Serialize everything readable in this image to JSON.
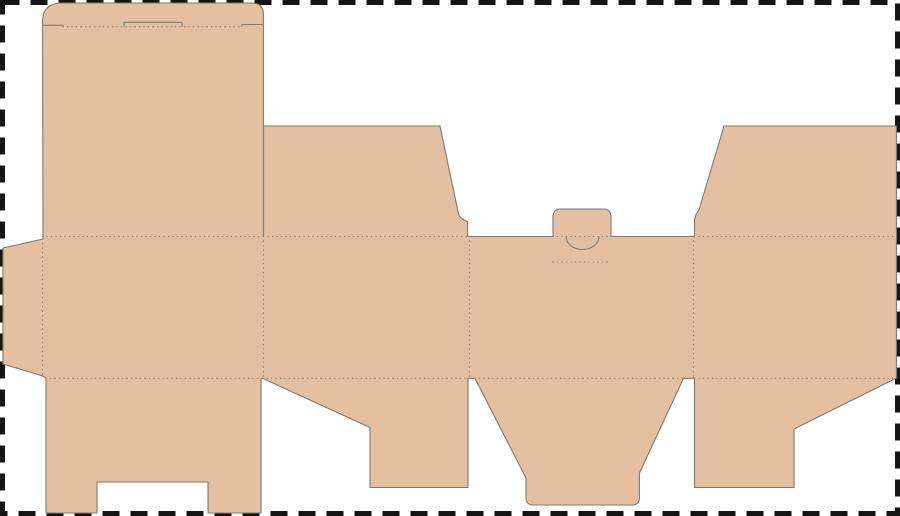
{
  "meta": {
    "description": "Flat packaging dieline (unfolded tuck-end box die-cut template) on a white artboard with a dashed trim border",
    "canvas": {
      "width": 900,
      "height": 516
    }
  },
  "colors": {
    "background": "#ffffff",
    "cardboard_fill": "#e5c0a0",
    "cut_line": "#7f7a72",
    "fold_line": "#8a7f70",
    "artboard_border": "#151515"
  },
  "artboard_border": {
    "inset": 2.5,
    "stroke_width": 5,
    "dash": "17 11"
  },
  "dieline": {
    "blank_path": "M 42.5,25.3 L 42.5,22 Q 42.5,3 62,3 L 251.5,3 Q 263.5,3 263.5,15 L 263.5,126 L 440,126 L 458.5,214 Q 460.5,219.5 467.5,221.5 L 467.5,236.5 L 553,236.5 L 553,217 Q 553,209 561,209 L 603,209 Q 611,209 611,217 L 611,236.5 L 694.5,236.5 L 694.5,221.5 Q 694.8,214.5 698.8,210.5 L 724,126 L 896.5,126 L 896.5,378 L 794,429 L 794,487.5 L 694.5,487.5 L 694.5,378.3 L 683.5,378.3 L 639.5,473 L 639.5,497.5 Q 639.5,505 632,505 L 533.5,505 Q 526,505 526,497.5 L 526,478 L 475,378.3 L 468,378.3 L 468,487.5 L 370,487.5 L 370,427.5 L 262.5,378.3 L 261,378.3 L 261,513 L 208,513 L 208,482 L 97,482 L 97,513 L 46,513 L 46,378.3 L 43,376 L 3,364 L 3,248 L 43,239 Z",
    "cut_lines": [
      {
        "name": "front-side-panel-divider-cut",
        "d": "M 263.5,126 L 263.5,236.5"
      },
      {
        "name": "lid-shoulder-cut-left",
        "d": "M 42.5,25.3 L 63,25.3 L 63,26.8"
      },
      {
        "name": "lid-shoulder-cut-right",
        "d": "M 242,26.8 L 242,24.5 L 263.5,24.5"
      },
      {
        "name": "lid-thumb-tab-cut",
        "d": "M 124,26.8 L 124,22.3 L 182,22.3 L 182,26.8"
      },
      {
        "name": "tuck-tab-thumb-notch-arc",
        "d": "M 566,236.5 A 16.5,13 0 0 0 599,236.5"
      }
    ],
    "fold_lines": [
      {
        "name": "lid-hinge-fold",
        "d": "M 63,26.8 L 243,26.8"
      },
      {
        "name": "top-fold-front-panel",
        "d": "M 42.5,236.5 L 263.5,236.5"
      },
      {
        "name": "top-fold-left-side-flap",
        "d": "M 263.5,236.5 L 467.5,236.5"
      },
      {
        "name": "top-fold-tuck-tab",
        "d": "M 553,236.5 L 611,236.5"
      },
      {
        "name": "top-fold-right-side-flap",
        "d": "M 694.5,236.5 L 896.5,236.5"
      },
      {
        "name": "tuck-tab-base-fold",
        "d": "M 553,262 L 611,262"
      },
      {
        "name": "bottom-fold-front-panel",
        "d": "M 46,378.3 L 261,378.3"
      },
      {
        "name": "bottom-fold-left-flap",
        "d": "M 262.5,378.3 L 468,378.3"
      },
      {
        "name": "bottom-fold-center-flap",
        "d": "M 475,378.3 L 683.5,378.3"
      },
      {
        "name": "bottom-fold-right-flap",
        "d": "M 694.5,378.3 L 896.5,378.3"
      },
      {
        "name": "glue-flap-fold",
        "d": "M 42.5,239 L 42.5,376"
      },
      {
        "name": "panel-fold-1",
        "d": "M 263.5,236.5 L 263.5,378.3"
      },
      {
        "name": "panel-fold-2",
        "d": "M 469.5,236.5 L 469.5,378.3"
      },
      {
        "name": "panel-fold-3",
        "d": "M 693.5,236.5 L 693.5,378.3"
      }
    ],
    "fold_dash": "0.1 4.4",
    "cut_width": 1.1,
    "fold_width": 1.3
  }
}
